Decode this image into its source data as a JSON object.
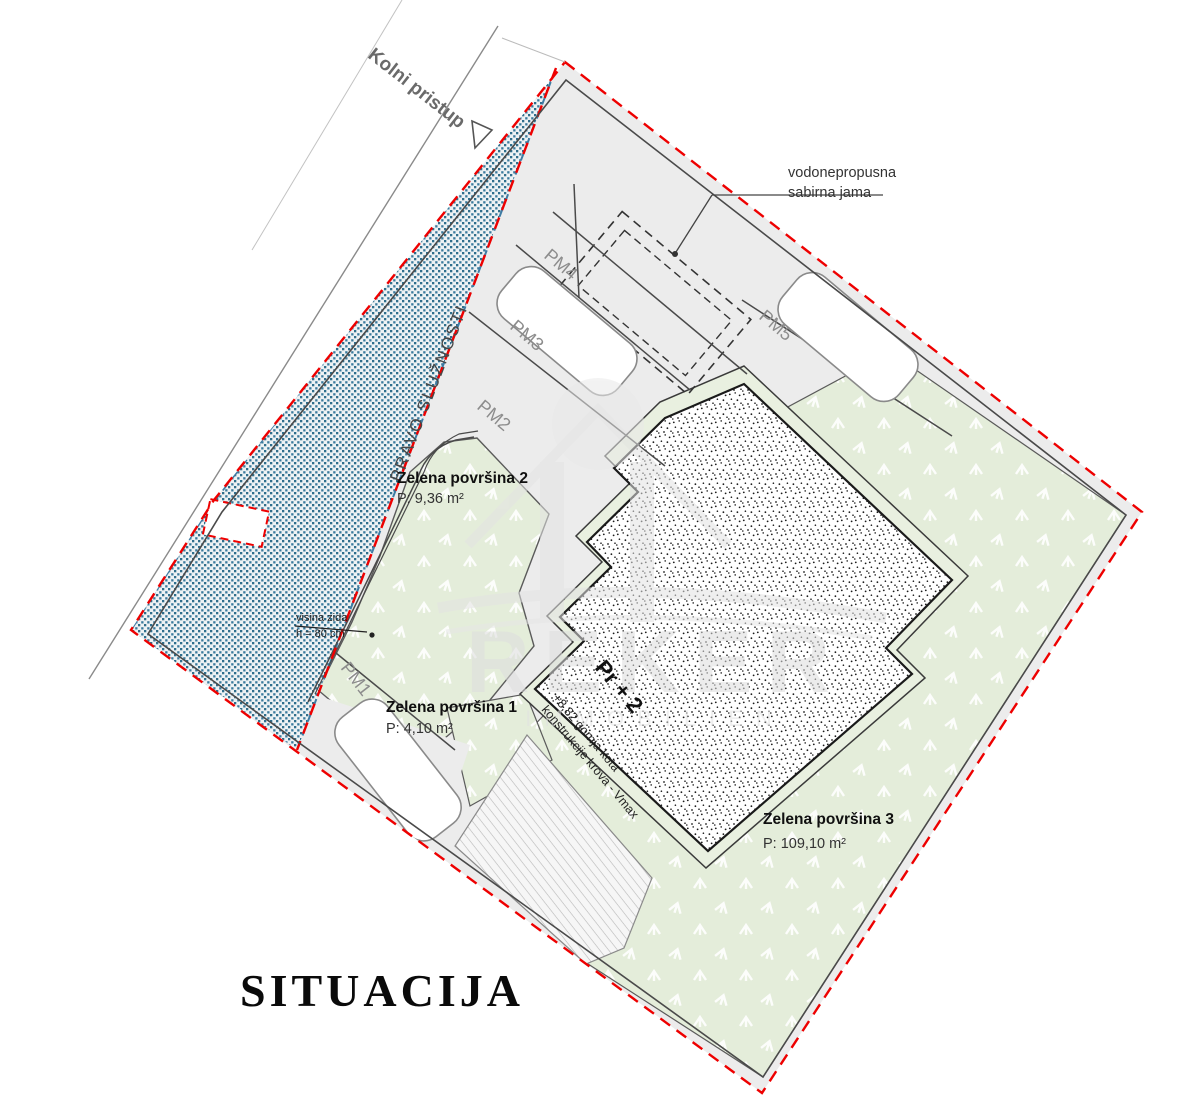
{
  "title": "SITUACIJA",
  "road": {
    "label": "Kolni pristup"
  },
  "servitude_label": "PRAVO SLUŽNOSTI",
  "pit_note": {
    "line1": "vodonepropusna",
    "line2": "sabirna jama"
  },
  "wall_note": {
    "line1": "visina zida",
    "line2": "h = 80 cm"
  },
  "parking": {
    "spots": [
      "PM1",
      "PM2",
      "PM3",
      "PM4",
      "PM5"
    ]
  },
  "green_areas": [
    {
      "name": "Zelena površina 1",
      "area": "P: 4,10 m²"
    },
    {
      "name": "Zelena površina 2",
      "area": "P: 9,36 m²"
    },
    {
      "name": "Zelena površina 3",
      "area": "P: 109,10 m²"
    }
  ],
  "building": {
    "label": "Pr + 2",
    "note_line1": "+8,82 gornja kota",
    "note_line2": "konstrukcije krova - Vmax"
  },
  "watermark": {
    "line1": "REKER",
    "line2": "IMMOBILIEN"
  },
  "colors": {
    "boundary_red": "#ee0000",
    "servitude_blue": "#3a7a9c",
    "green_fill": "#e4edda",
    "gray_fill": "#ececec"
  }
}
